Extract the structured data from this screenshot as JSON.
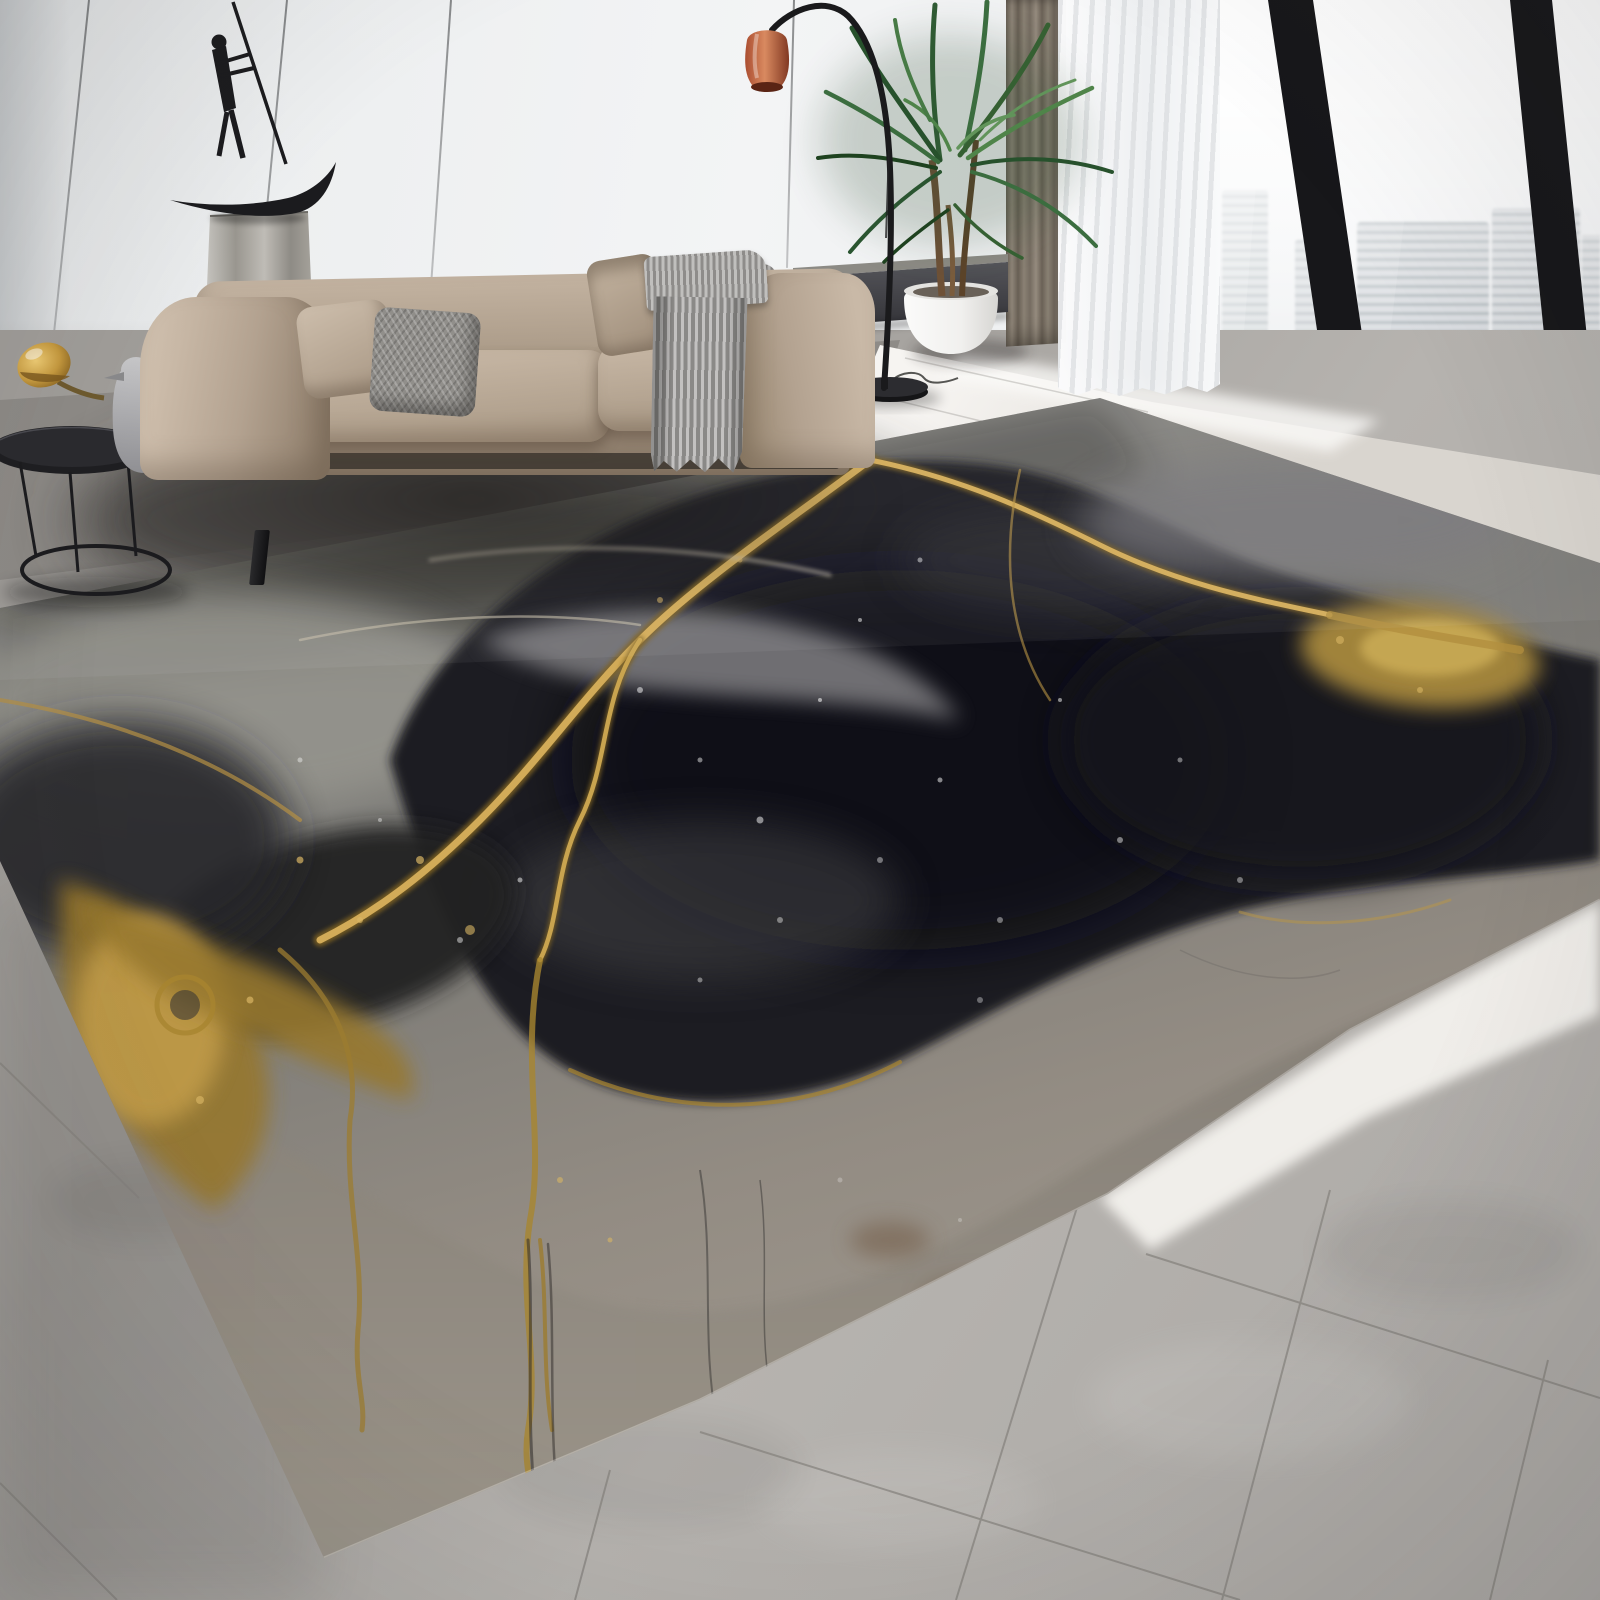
{
  "image": {
    "type": "product-photograph",
    "subject": "abstract black, gray and gold alcohol-ink marble area rug in a modern living room",
    "visible_text": []
  },
  "palette": {
    "wall": "#edeff0",
    "wall-shade": "#c5c8ca",
    "curtain-taupe": "#80776b",
    "curtain-sheer": "#f7f8f9",
    "frame": "#17171a",
    "sky": "#fbfcfc",
    "building": "#c3cad0",
    "building-teal": "#b7c8c1",
    "floor-bright": "#f1efeb",
    "floor-mid": "#a9a6a2",
    "floor-dark": "#565350",
    "tile": "#b4b1ad",
    "tile-line": "#84817c",
    "rug-gray": "#85847f",
    "rug-black": "#1d1d20",
    "rug-taupe": "#8d867d",
    "gold": "#b18b3c",
    "gold-bright": "#d9b564",
    "gold-deep": "#7e6223",
    "sofa": "#b3a290",
    "sofa-light": "#c3b3a1",
    "sofa-dark": "#8a7966",
    "pillow-gray": "#918f8b",
    "throw": "#a5a3a1",
    "metal": "#1b1b1e",
    "pedestal": "#b4b1ab",
    "copper": "#c0603c",
    "plant": "#3b6d3f",
    "plant-dark": "#24482a",
    "pot": "#f4f3f1",
    "figurine": "#b5b5b8"
  },
  "objects": {
    "rug": {
      "style": "alcohol-ink marble",
      "colors": [
        "black",
        "charcoal",
        "taupe",
        "metallic gold veins"
      ]
    },
    "sofa": {
      "upholstery": "beige velvet",
      "pillows": 3,
      "throw": "gray ribbed blanket"
    },
    "side_table": "black wire round table",
    "figurine": "gray penguin with gold mushroom lamp",
    "sculpture": "black rower figure on crescent boat, stone pedestal",
    "floor_lamp": "black arc lamp with copper shade",
    "plant": "areca palm in white egg pot",
    "window": {
      "mullions": 2,
      "view": "hazy high-rise skyline"
    },
    "curtains": [
      "taupe drape",
      "white sheer"
    ],
    "floor": {
      "near_window": "polished light marble",
      "foreground": "large gray tiles"
    }
  }
}
